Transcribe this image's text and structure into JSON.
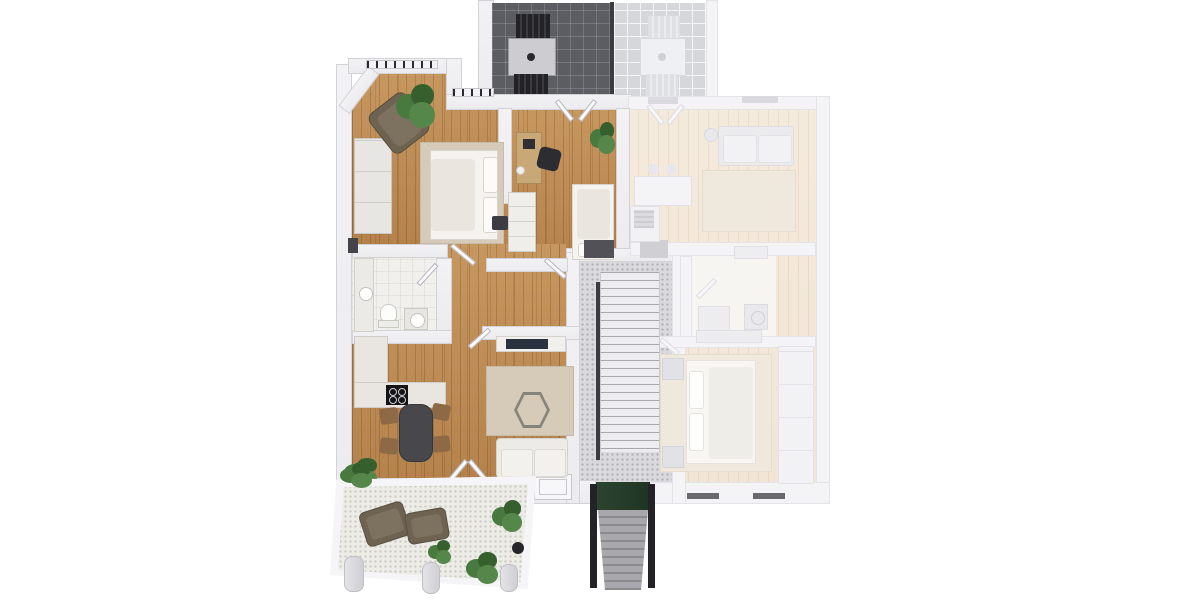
{
  "scene": {
    "kind": "3d-rendered-floor-plan-top-view",
    "units": {
      "highlighted_unit": "left-apartment",
      "dimmed_unit": "right-apartment"
    },
    "rooms_highlighted": [
      "bedroom",
      "office-bedroom",
      "bathroom",
      "kitchen-dining",
      "living-room",
      "hallway",
      "balcony-terrace",
      "roof-terrace-dark-tiles"
    ],
    "rooms_dimmed": [
      "living-kitchen",
      "hallway-bathroom",
      "bedroom",
      "roof-terrace-light-tiles"
    ],
    "shared": [
      "central-stairwell",
      "entrance-steps"
    ],
    "furniture_highlighted": [
      "double-bed",
      "wardrobe",
      "lounge-chair",
      "potted-plants",
      "desk",
      "desk-chair",
      "shelf-unit",
      "single-bed",
      "toilet",
      "vanity",
      "sink",
      "kitchen-counter",
      "cooktop",
      "dining-table",
      "dining-chairs",
      "tv-console",
      "tv",
      "area-rug",
      "hex-side-table",
      "sofa",
      "terrace-loungers",
      "terrace-table-set"
    ],
    "furniture_dimmed": [
      "sofa",
      "floor-lamp",
      "area-rug",
      "kitchen-island",
      "bar-stools",
      "appliance",
      "sideboard",
      "bath-cabinet",
      "washer",
      "double-bed",
      "nightstands",
      "wardrobe",
      "terrace-table-set"
    ]
  },
  "palette": {
    "bg": "#ffffff",
    "wall": "#ececee",
    "wall_edge": "#d2d2d7",
    "faded_wall": "#f4f4f6",
    "wood": "#b5824c",
    "wood_light": "#c79760",
    "faded_floor": "#f1e5d5",
    "bath_floor": "#f1f0ec",
    "stair_floor": "#dadade",
    "stair_step": "#ededf0",
    "tile_dark": "#5c5d63",
    "tile_light": "#d6d7db",
    "rail_dark": "#3b3b41",
    "rug": "#d5cbb8",
    "rug_faded": "#efe8dd",
    "bed_white": "#f5f3ef",
    "sofa": "#edebe7",
    "table_dark": "#47474c",
    "chair_brown": "#8d6a45",
    "olive": "#6e6350",
    "plant": "#48793f",
    "plant_dark": "#35602e",
    "counter": "#e9e6e1",
    "cooktop": "#141417",
    "tv_navy": "#2a3140",
    "green_mat": "#2b4430",
    "dark_wall": "#232327",
    "window_bar": "#1f1f24",
    "mat_gray": "#515157"
  }
}
